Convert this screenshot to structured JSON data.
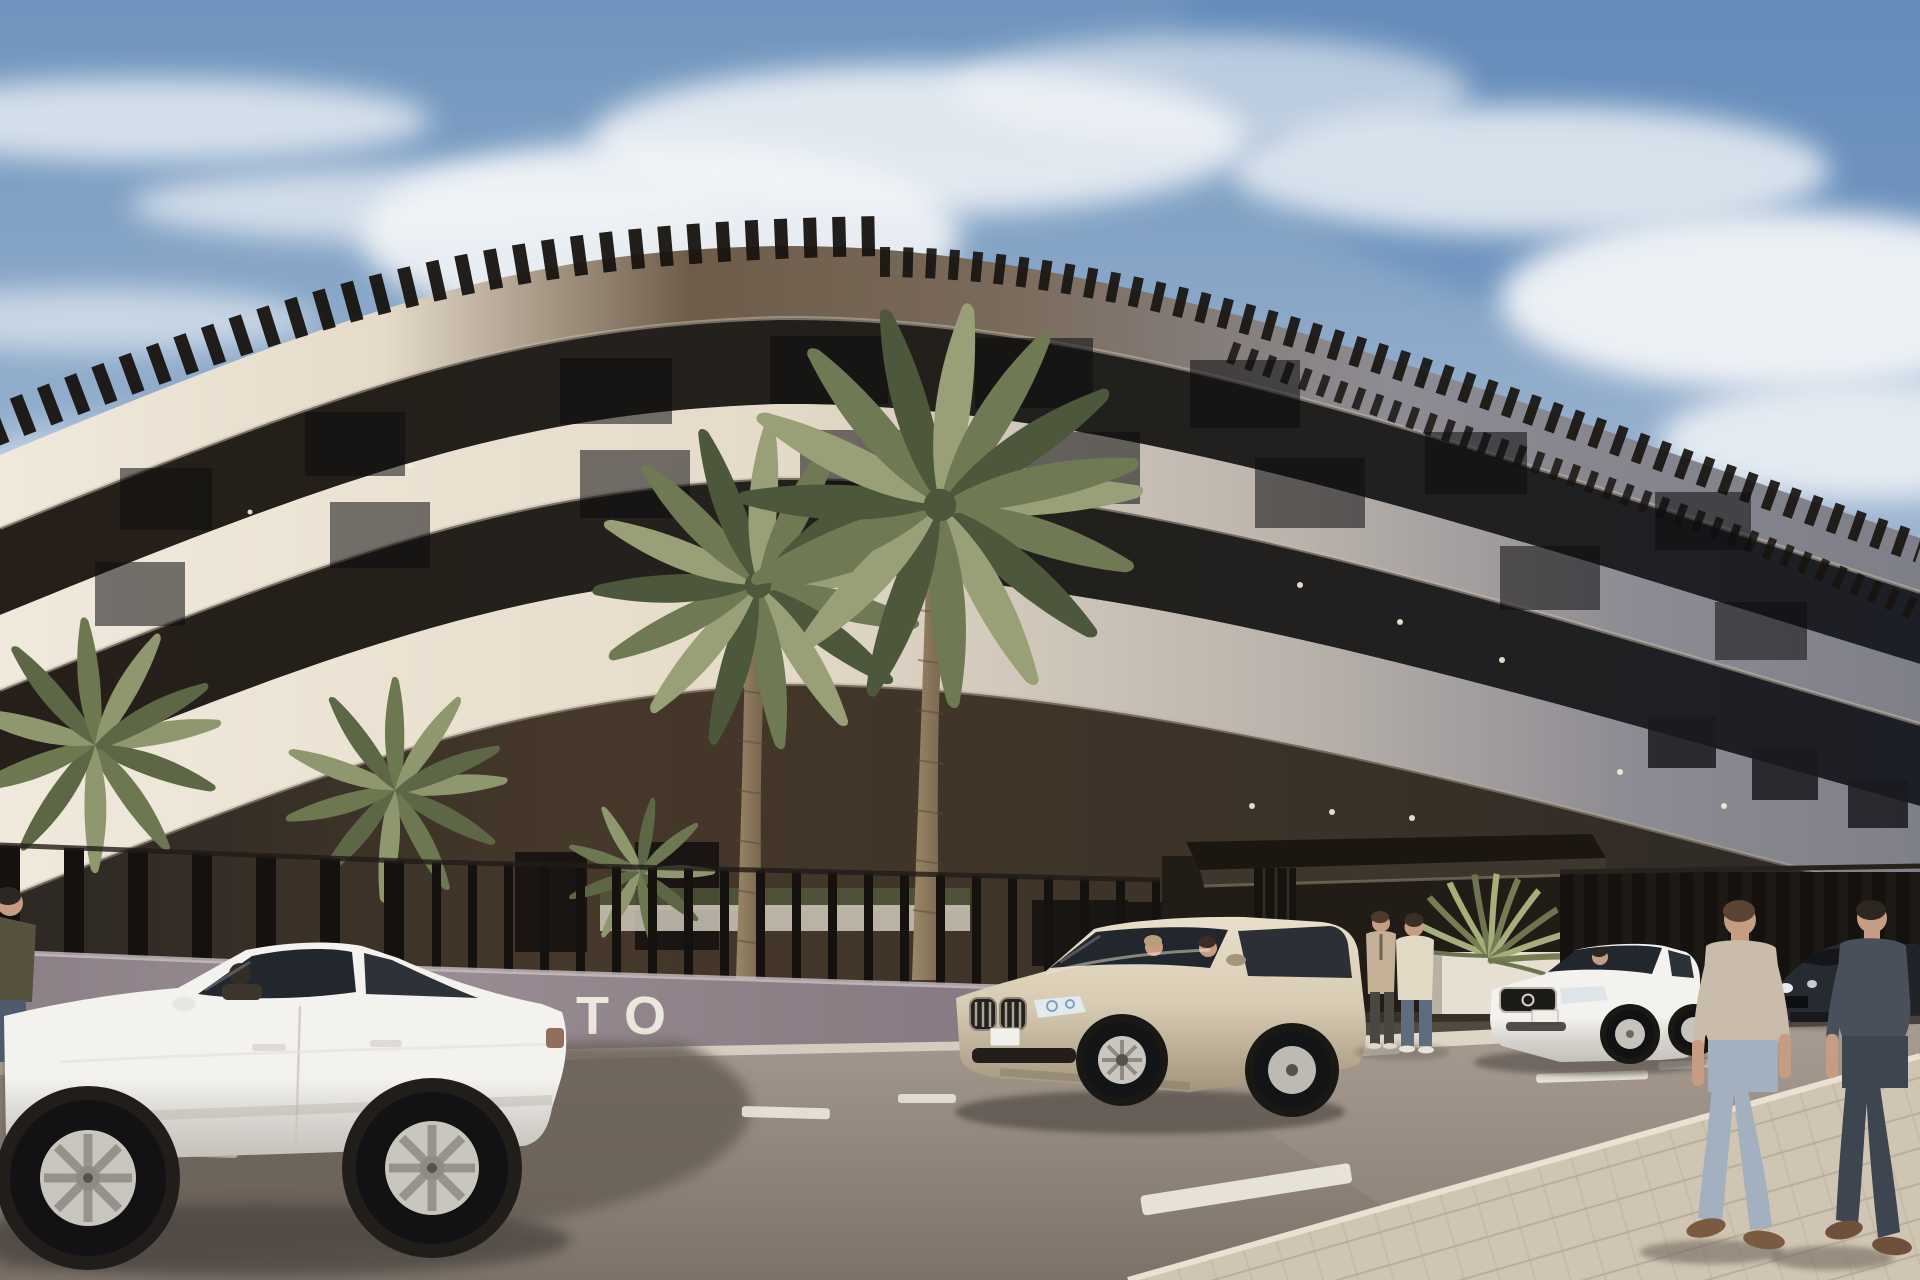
{
  "scene": {
    "title": "New-build apartment complex — exterior street view",
    "description": "Photorealistic architectural rendering of a long curved modern apartment building with rooftop pergola slats, white curved floor bands, recessed glazed floors, a dark slatted perimeter fence, palm trees, parked cars and pedestrians on a sunny street",
    "time_of_day": "daytime",
    "style": "photorealistic CGI render"
  },
  "wall_sign": {
    "text": "TO",
    "note": "white letters on street wall, partially hidden behind white sedan"
  },
  "colors": {
    "sky_top": "#6f94bd",
    "sky_mid": "#9ab3cf",
    "sky_low": "#cdd9e4",
    "cloud": "#f2f5f8",
    "band_cream": "#f0e9dc",
    "band_cream2": "#e6dbc9",
    "band_bronze": "#6e5c49",
    "band_grey": "#8d8b93",
    "band_grey2": "#7e7f89",
    "recess_dark": "#261f19",
    "recess_dark2": "#1d1f26",
    "ground_brown": "#46382a",
    "ground_dark": "#2c2824",
    "pergola": "#17130f",
    "fence": "#14110e",
    "wall_mauve": "#9a8d94",
    "wall_mauve2": "#8b7e85",
    "planter_white": "#e6dfd2",
    "curb": "#ddd5c5",
    "canopy": "#1b160f",
    "palm_light": "#99a077",
    "palm_mid": "#6f7a55",
    "palm_dark": "#4d573b",
    "trunk": "#9b886a",
    "trunk_dark": "#6e5d45",
    "asphalt_light": "#a59a8f",
    "asphalt_dark": "#7c7268",
    "road_shadow": "#675e57",
    "marking": "#ece7dc",
    "sidewalk": "#cfc5b2",
    "sidewalk_line": "#b3a996",
    "car_white": "#f3f2ee",
    "car_white_shade": "#d7d4cf",
    "glass_dark": "#22262d",
    "car_champagne": "#d8cbb3",
    "car_champagne_dark": "#a3957c",
    "car_dark": "#262a31",
    "skin": "#c69d82",
    "tee_light": "#c9bcab",
    "jeans_light": "#a3b0bf",
    "tee_dark": "#49505c",
    "jeans_dark": "#3d4550",
    "sweater_cream": "#e2d9c4",
    "blazer_beige": "#c3b095",
    "trouser_dark": "#4a4742"
  },
  "objects": {
    "building": {
      "name": "curved apartment block",
      "floors_visible": 3,
      "features": [
        "rooftop pergola slats",
        "white curved floor bands",
        "recessed glazed floors",
        "dark ground floor",
        "slatted perimeter fence",
        "dark entrance canopy",
        "small facade downlights"
      ]
    },
    "vehicles": [
      {
        "name": "white sedan",
        "view": "side",
        "position": "foreground left, driver inside"
      },
      {
        "name": "champagne SUV",
        "view": "front three-quarter",
        "position": "center, two occupants"
      },
      {
        "name": "white sedan",
        "view": "front three-quarter",
        "position": "right, parked, driver inside"
      },
      {
        "name": "dark sedan",
        "view": "front",
        "position": "far right, parked"
      }
    ],
    "people": [
      {
        "name": "partial standing figure",
        "position": "far left edge"
      },
      {
        "name": "two men talking",
        "position": "entrance walkway"
      },
      {
        "name": "man in light t-shirt walking away",
        "position": "lower right sidewalk"
      },
      {
        "name": "man in dark t-shirt walking away",
        "position": "lower right sidewalk"
      }
    ],
    "vegetation": [
      "two tall palm trees in courtyard",
      "low palms and hedges behind fence",
      "yucca in white entrance planter"
    ],
    "road": {
      "markings": [
        "dashed white lane lines",
        "white edge line",
        "parking bay ticks"
      ],
      "surfaces": [
        "asphalt street",
        "paved sidewalk lower right",
        "light curb strips"
      ]
    }
  }
}
